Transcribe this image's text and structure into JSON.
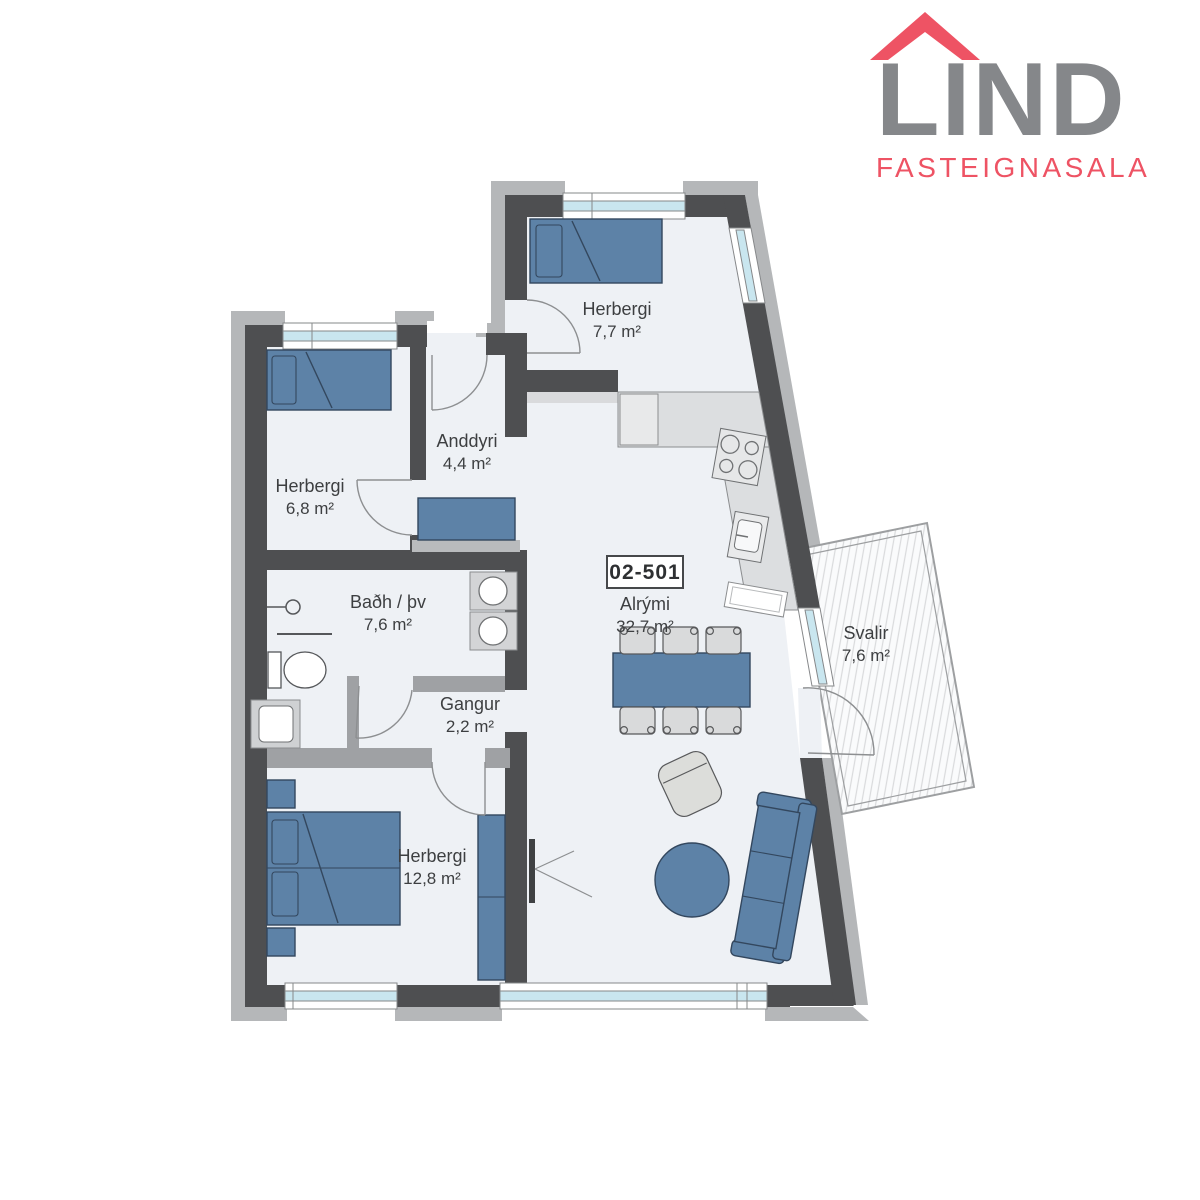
{
  "logo": {
    "brand": "LIND",
    "tagline": "FASTEIGNASALA",
    "roof_color": "#ee5364",
    "brand_color": "#85878a",
    "tagline_color": "#ee5364"
  },
  "unit": {
    "number": "02-501"
  },
  "rooms": [
    {
      "id": "herbergi-top",
      "name": "Herbergi",
      "area": "7,7 m²"
    },
    {
      "id": "herbergi-left",
      "name": "Herbergi",
      "area": "6,8 m²"
    },
    {
      "id": "anddyri",
      "name": "Anddyri",
      "area": "4,4 m²"
    },
    {
      "id": "badherbergi",
      "name": "Baðh / þv",
      "area": "7,6 m²"
    },
    {
      "id": "gangur",
      "name": "Gangur",
      "area": "2,2 m²"
    },
    {
      "id": "herbergi-master",
      "name": "Herbergi",
      "area": "12,8 m²"
    },
    {
      "id": "alrymi",
      "name": "Alrými",
      "area": "32,7 m²"
    },
    {
      "id": "svalir",
      "name": "Svalir",
      "area": "7,6 m²"
    }
  ],
  "colors": {
    "wall_dark": "#4e4f51",
    "wall_outer": "#b5b7b9",
    "wall_medium": "#9fa1a4",
    "floor": "#eef1f5",
    "glass": "#c9e6ef",
    "furniture_blue": "#5d82a7",
    "furniture_stroke": "#33475e",
    "counter": "#dcdee0",
    "chair": "#d9dadb"
  }
}
